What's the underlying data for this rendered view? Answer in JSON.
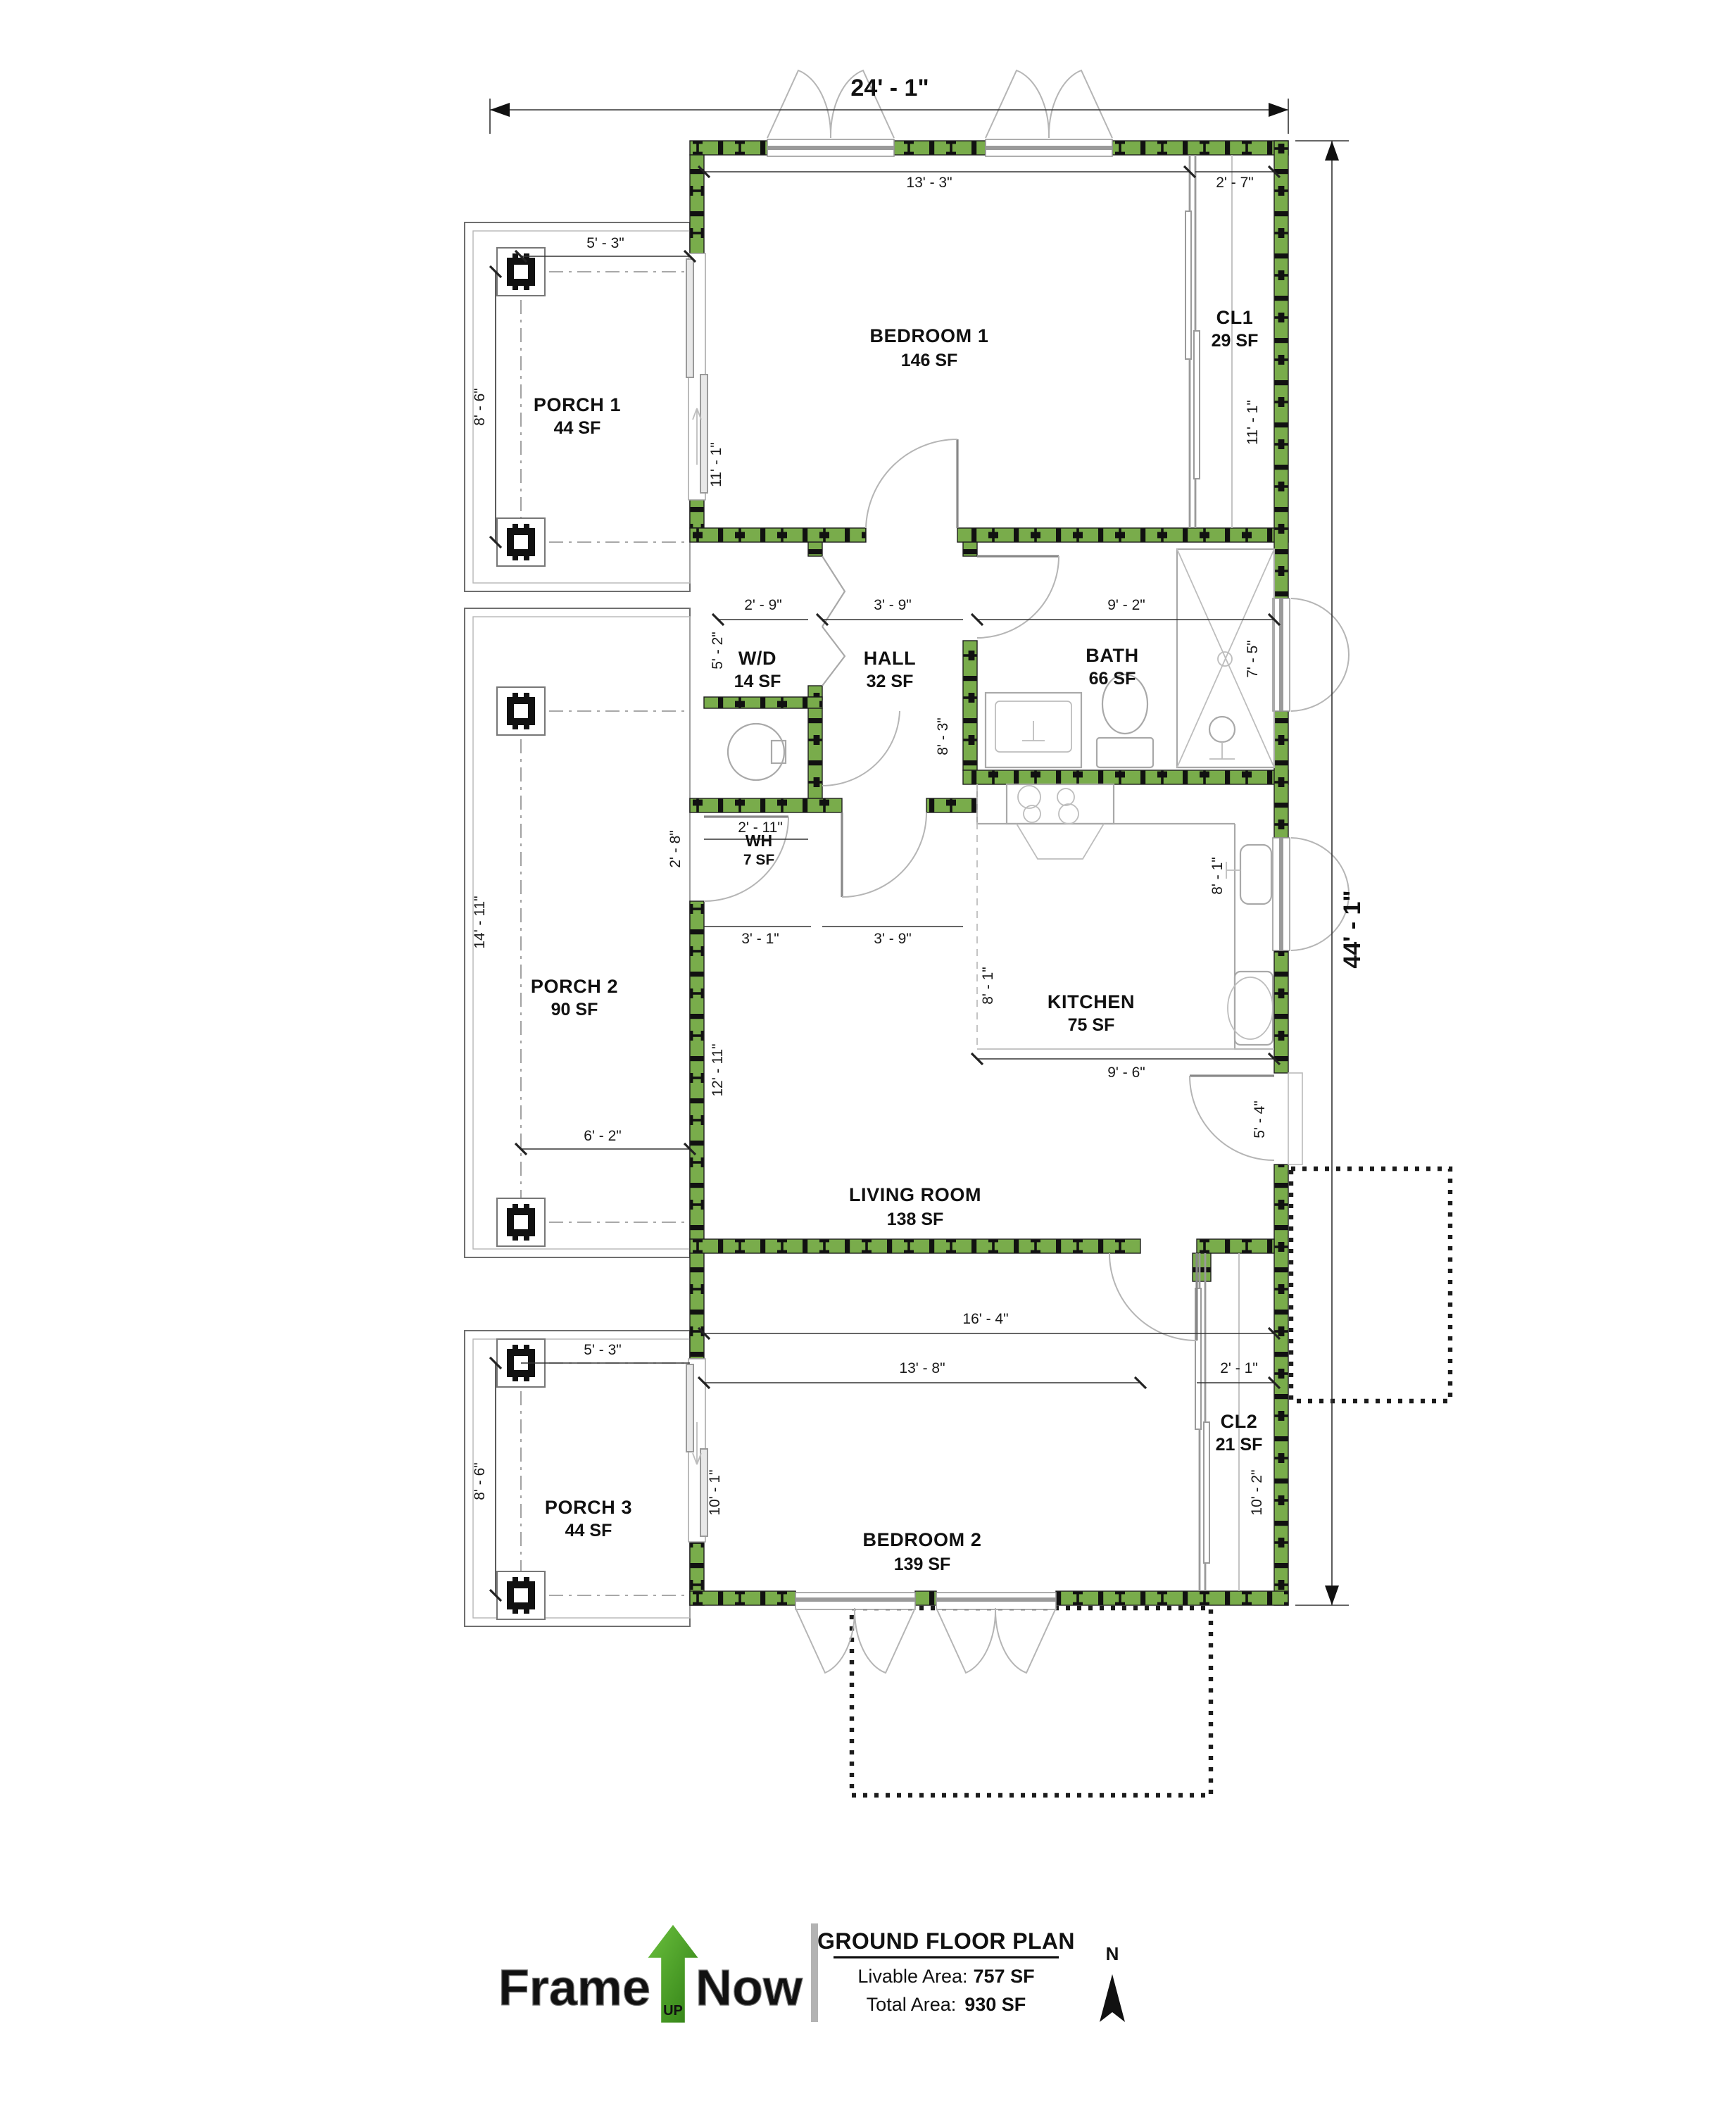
{
  "plan": {
    "sheet_title": "GROUND FLOOR PLAN",
    "livable_area_label": "Livable Area:",
    "livable_area_value": "757 SF",
    "total_area_label": "Total Area:",
    "total_area_value": "930 SF",
    "north_label": "N",
    "logo": {
      "frame": "Frame",
      "up": "UP",
      "now": "Now"
    },
    "colors": {
      "wall_green": "#79AC4B",
      "stud_black": "#111111",
      "logo_green": "#53A82F",
      "partition_gray": "#9a9a9a"
    }
  },
  "rooms": [
    {
      "name": "PORCH 1",
      "area": "44 SF"
    },
    {
      "name": "BEDROOM 1",
      "area": "146 SF"
    },
    {
      "name": "CL1",
      "area": "29 SF"
    },
    {
      "name": "W/D",
      "area": "14 SF"
    },
    {
      "name": "HALL",
      "area": "32 SF"
    },
    {
      "name": "BATH",
      "area": "66 SF"
    },
    {
      "name": "WH",
      "area": "7 SF"
    },
    {
      "name": "PORCH 2",
      "area": "90 SF"
    },
    {
      "name": "KITCHEN",
      "area": "75 SF"
    },
    {
      "name": "LIVING ROOM",
      "area": "138 SF"
    },
    {
      "name": "PORCH 3",
      "area": "44 SF"
    },
    {
      "name": "BEDROOM 2",
      "area": "139 SF"
    },
    {
      "name": "CL2",
      "area": "21 SF"
    }
  ],
  "dimensions": {
    "top_width": "24' - 1\"",
    "overall_height": "44' - 1\"",
    "bedroom1_width": "13' - 3\"",
    "cl1_width": "2' - 7\"",
    "porch1_width": "5' - 3\"",
    "porch1_depth": "8' - 6\"",
    "bedroom1_side": "11' - 1\"",
    "cl1_side": "11' - 1\"",
    "wd_width": "2' - 9\"",
    "hall_width": "3' - 9\"",
    "bath_width": "9' - 2\"",
    "wd_side": "5' - 2\"",
    "hall_side": "8' - 3\"",
    "bath_side": "7' - 5\"",
    "wh_width": "2' - 11\"",
    "wh_side": "2' - 8\"",
    "wh_below_left": "3' - 1\"",
    "wh_below_right": "3' - 9\"",
    "porch2_side": "14' - 11\"",
    "porch2_width": "6' - 2\"",
    "living_side": "12' - 11\"",
    "kitchen_side_left": "8' - 1\"",
    "kitchen_side_right": "8' - 1\"",
    "kitchen_width": "9' - 6\"",
    "entry_side": "5' - 4\"",
    "living_width": "16' - 4\"",
    "bedroom2_width": "13' - 8\"",
    "cl2_width": "2' - 1\"",
    "porch3_width": "5' - 3\"",
    "porch3_depth": "8' - 6\"",
    "bedroom2_side": "10' - 1\"",
    "cl2_side": "10' - 2\""
  }
}
